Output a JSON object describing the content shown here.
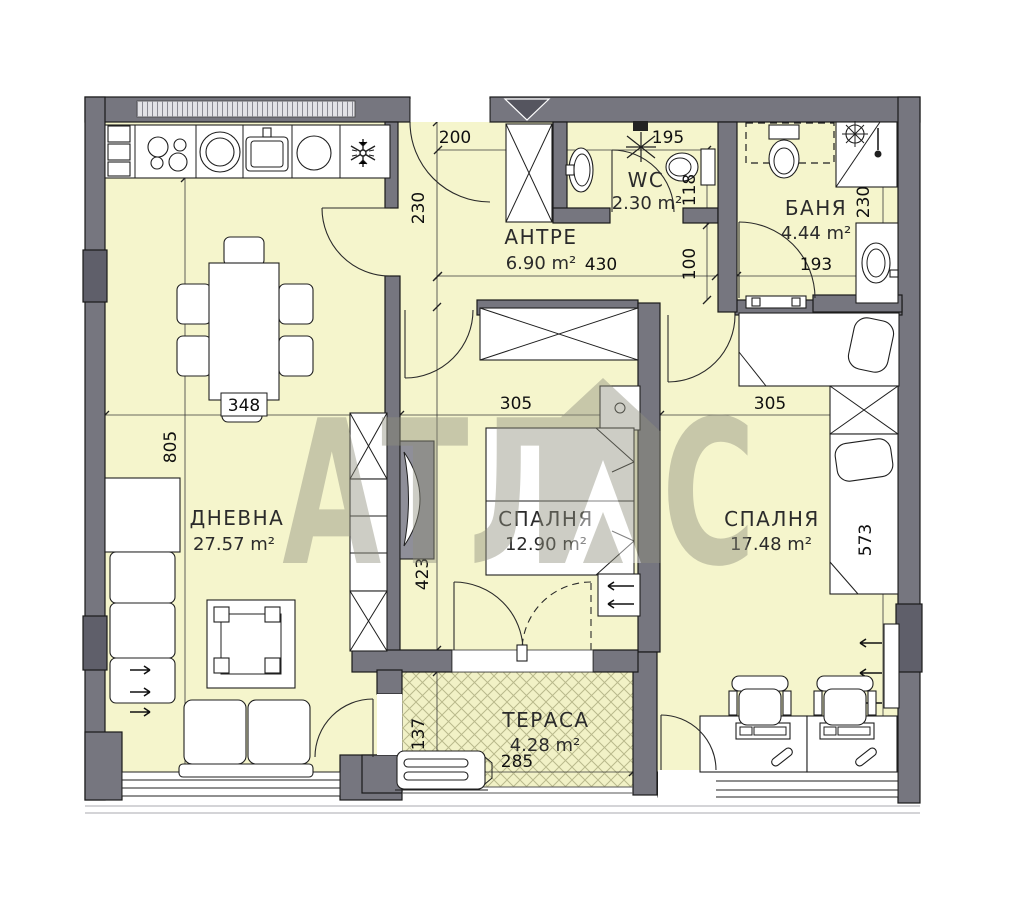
{
  "plan": {
    "watermark": {
      "left": "АТЛ",
      "right": "С",
      "brand": "АТЛАС"
    },
    "rooms": {
      "living": {
        "name": "ДНЕВНА",
        "area": "27.57 m²"
      },
      "hall": {
        "name": "АНТРЕ",
        "area": "6.90 m²"
      },
      "wc": {
        "name": "WC",
        "area": "2.30 m²"
      },
      "bath": {
        "name": "БАНЯ",
        "area": "4.44 m²"
      },
      "bedroom1": {
        "name": "СПАЛНЯ",
        "area": "12.90 m²"
      },
      "bedroom2": {
        "name": "СПАЛНЯ",
        "area": "17.48 m²"
      },
      "terrace": {
        "name": "ТЕРАСА",
        "area": "4.28 m²"
      }
    },
    "dims": {
      "entry_width": "200",
      "kitchen_side": "230",
      "hall_width": "430",
      "wc_width": "195",
      "wc_depth": "118",
      "corridor": "100",
      "bath_door": "193",
      "bath_side": "230",
      "living_width": "348",
      "bedroom1_width": "305",
      "bedroom2_width": "305",
      "living_depth": "805",
      "bedroom1_depth": "423",
      "bedroom2_depth": "573",
      "terrace_depth": "137",
      "terrace_width": "285"
    },
    "colors": {
      "floor": "#f5f5cc",
      "wall": "#76767f",
      "hatch": "#b9b98c",
      "watermark": "#8f8f7d",
      "line": "#1f1f1f"
    }
  }
}
